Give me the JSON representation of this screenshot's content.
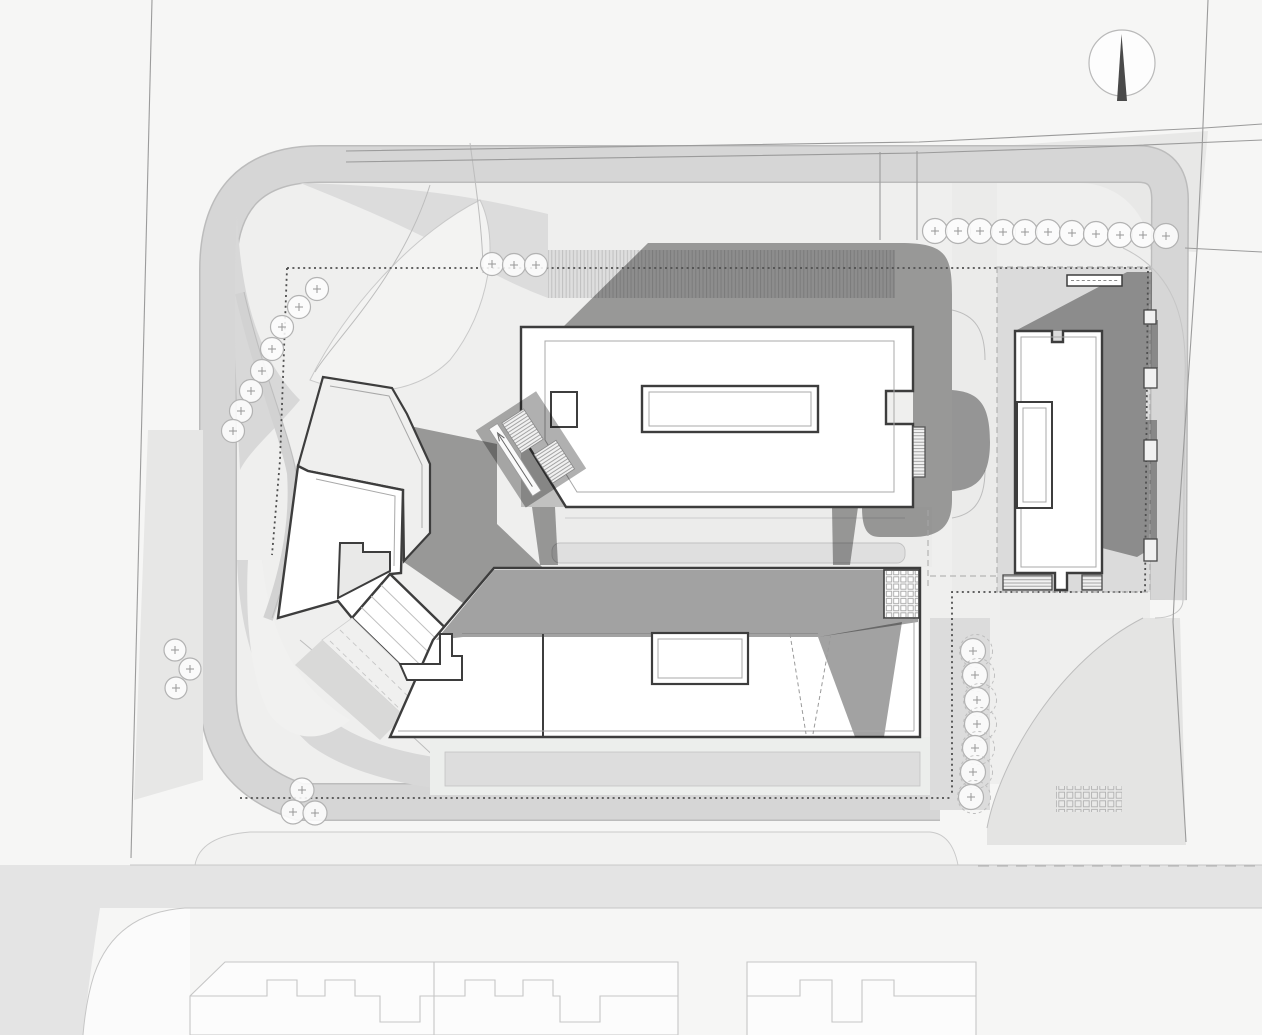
{
  "meta": {
    "drawing_type": "architectural-site-plan",
    "description": "Monochrome masterplan / site plan with four new buildings casting north-east shadows, perimeter loop road, tree rows, fence line and neighbouring buildings at the bottom",
    "orientation": "north-up"
  },
  "palette": {
    "page": "#f6f6f5",
    "road": "#e4e4e4",
    "band": "#d6d6d6",
    "bandEdge": "#bcbcbc",
    "interior": "#efefee",
    "gray1": "#dcdcdc",
    "gray2": "#d8d8d8",
    "light1": "#f3f3f2",
    "parcel": "#dbdbdb",
    "outline": "#3d3d3d",
    "thin": "#a8a8a8",
    "boundary": "#9b9b9b",
    "neighbor": "#c6c6c6",
    "tree": "#b2b2b2",
    "fence": "#4f4f4f"
  },
  "compass": {
    "cx": 1122,
    "cy": 63,
    "r": 33,
    "needle": "north"
  },
  "buildings": [
    {
      "id": "north-slab",
      "shape": "long rectangle with side notches and inner court"
    },
    {
      "id": "east-slab",
      "shape": "vertical slab with court, canopy and balconies"
    },
    {
      "id": "west-polygon",
      "shape": "faceted block with upper terrace and notch"
    },
    {
      "id": "south-bar",
      "shape": "long bar with court, ramp marking and roof grid"
    }
  ],
  "trees": {
    "groups": [
      {
        "name": "top-row",
        "r": 12.5,
        "points": [
          [
            935,
            231
          ],
          [
            958,
            231
          ],
          [
            980,
            231
          ],
          [
            1003,
            232
          ],
          [
            1025,
            232
          ],
          [
            1048,
            232
          ],
          [
            1072,
            233
          ],
          [
            1096,
            234
          ],
          [
            1120,
            235
          ],
          [
            1143,
            235
          ],
          [
            1166,
            236
          ]
        ]
      },
      {
        "name": "top-center-row",
        "r": 11.5,
        "points": [
          [
            492,
            264
          ],
          [
            514,
            265
          ],
          [
            536,
            265
          ]
        ]
      },
      {
        "name": "west-column",
        "r": 11.5,
        "points": [
          [
            317,
            289
          ],
          [
            299,
            307
          ],
          [
            282,
            327
          ],
          [
            272,
            349
          ],
          [
            262,
            371
          ],
          [
            251,
            391
          ],
          [
            241,
            411
          ],
          [
            233,
            431
          ]
        ]
      },
      {
        "name": "west-lower-cluster",
        "r": 11,
        "points": [
          [
            175,
            650
          ],
          [
            190,
            669
          ],
          [
            176,
            688
          ]
        ]
      },
      {
        "name": "south-west-cluster",
        "r": 12,
        "points": [
          [
            302,
            790
          ],
          [
            293,
            812
          ],
          [
            315,
            813
          ]
        ]
      },
      {
        "name": "east-column",
        "r": 12.5,
        "dashed_ring": true,
        "points": [
          [
            973,
            651
          ],
          [
            975,
            675
          ],
          [
            977,
            700
          ],
          [
            977,
            724
          ],
          [
            975,
            748
          ],
          [
            973,
            772
          ],
          [
            971,
            797
          ]
        ]
      }
    ]
  }
}
